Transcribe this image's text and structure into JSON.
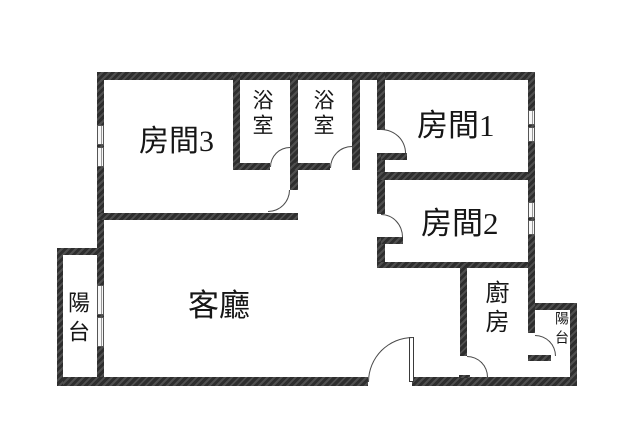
{
  "floorplan": {
    "type": "apartment-floor-plan",
    "labels": {
      "room3": "房間3",
      "bath1": "浴室",
      "bath2": "浴室",
      "room1": "房間1",
      "room2": "房間2",
      "living": "客廳",
      "kitchen": "廚房",
      "balcony_left": "陽台",
      "balcony_right": "陽台"
    },
    "colors": {
      "wall": "#3a3a3a",
      "door_line": "#4a4a4a",
      "background": "#ffffff"
    }
  }
}
